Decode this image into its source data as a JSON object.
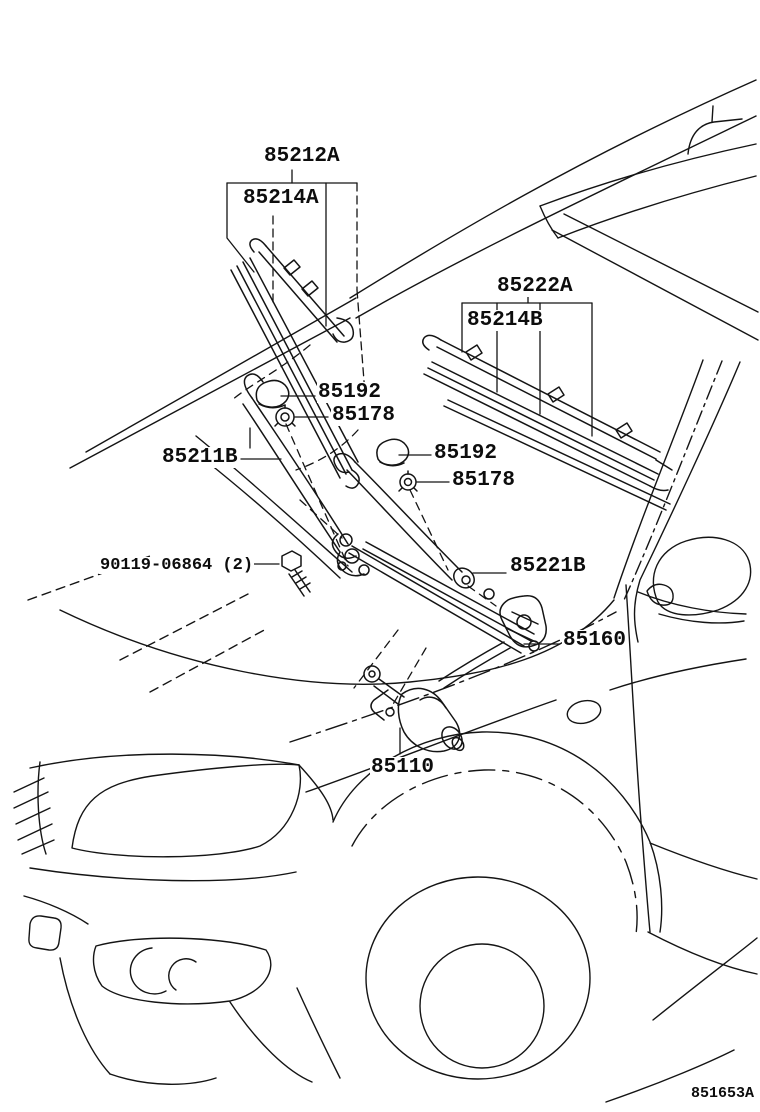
{
  "diagram": {
    "figure_code": "851653A",
    "line_color": "#141414",
    "background_color": "#ffffff",
    "callouts": {
      "blade1_assembly": "85212A",
      "blade1_rubber": "85214A",
      "blade2_assembly": "85222A",
      "blade2_rubber": "85214B",
      "cap_front": "85192",
      "nut_front": "85178",
      "cap_rear": "85192",
      "nut_rear": "85178",
      "arm_driver": "85211B",
      "mount_bolt": "90119-06864 (2)",
      "arm_passenger": "85221B",
      "link_assembly": "85160",
      "motor": "85110"
    }
  }
}
